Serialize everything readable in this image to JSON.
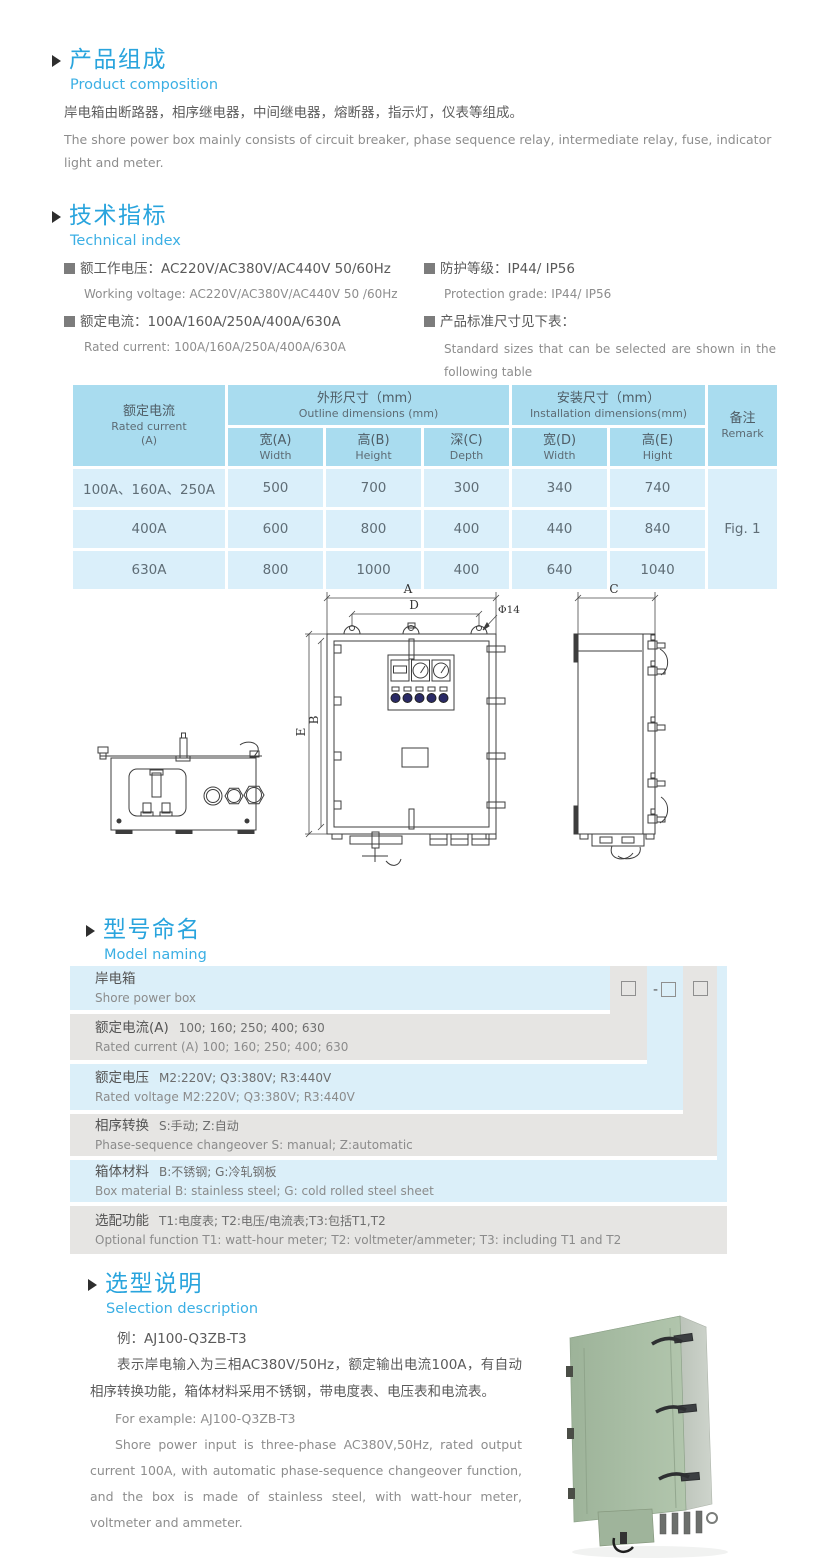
{
  "sec1": {
    "title_cn": "产品组成",
    "title_en": "Product  composition",
    "body_cn": "岸电箱由断路器，相序继电器，中间继电器，熔断器，指示灯，仪表等组成。",
    "body_en": "The shore power box mainly consists of circuit breaker, phase sequence relay, intermediate relay, fuse, indicator light and meter."
  },
  "sec2": {
    "title_cn": "技术指标",
    "title_en": "Technical index",
    "specs": [
      {
        "cn": "额工作电压：AC220V/AC380V/AC440V  50/60Hz",
        "en": "Working voltage: AC220V/AC380V/AC440V 50 /60Hz"
      },
      {
        "cn": "额定电流：100A/160A/250A/400A/630A",
        "en": "Rated current: 100A/160A/250A/400A/630A"
      },
      {
        "cn": "防护等级：IP44/ IP56",
        "en": "Protection grade: IP44/ IP56"
      },
      {
        "cn": "产品标准尺寸见下表：",
        "en": "Standard sizes that can be selected are shown in the following table"
      }
    ]
  },
  "dim_table": {
    "header": {
      "current_cn": "额定电流",
      "current_en": "Rated current",
      "current_unit": "(A)",
      "outline_cn": "外形尺寸（mm）",
      "outline_en": "Outline dimensions (mm)",
      "install_cn": "安装尺寸（mm）",
      "install_en": "Installation dimensions(mm)",
      "remark_cn": "备注",
      "remark_en": "Remark",
      "cols": [
        {
          "cn": "宽(A)",
          "en": "Width"
        },
        {
          "cn": "高(B)",
          "en": "Height"
        },
        {
          "cn": "深(C)",
          "en": "Depth"
        },
        {
          "cn": "宽(D)",
          "en": "Width"
        },
        {
          "cn": "高(E)",
          "en": "Hight"
        }
      ]
    },
    "rows": [
      {
        "current": "100A、160A、250A",
        "a": "500",
        "b": "700",
        "c": "300",
        "d": "340",
        "e": "740"
      },
      {
        "current": "400A",
        "a": "600",
        "b": "800",
        "c": "400",
        "d": "440",
        "e": "840"
      },
      {
        "current": "630A",
        "a": "800",
        "b": "1000",
        "c": "400",
        "d": "640",
        "e": "1040"
      }
    ],
    "remark": "Fig. 1"
  },
  "drawing": {
    "labels": {
      "a": "A",
      "d": "D",
      "dia": "Φ14",
      "e": "E",
      "b": "B",
      "c": "C"
    }
  },
  "sec3": {
    "title_cn": "型号命名",
    "title_en": "Model naming",
    "prefix": "AJ",
    "dash": "-",
    "rows": [
      {
        "cn": "岸电箱",
        "en": "Shore power box"
      },
      {
        "cn": "额定电流(A)",
        "detail": "100; 160; 250; 400; 630",
        "en": "Rated current (A) 100; 160; 250; 400; 630"
      },
      {
        "cn": "额定电压",
        "detail": "M2:220V;  Q3:380V;  R3:440V",
        "en": "Rated voltage  M2:220V;  Q3:380V;  R3:440V"
      },
      {
        "cn": "相序转换",
        "detail": "S:手动; Z:自动",
        "en": "Phase-sequence changeover  S: manual;  Z:automatic"
      },
      {
        "cn": "箱体材料",
        "detail": "B:不锈钢;  G:冷轧钢板",
        "en": "Box material   B: stainless steel; G: cold rolled steel sheet"
      },
      {
        "cn": "选配功能",
        "detail": "T1:电度表;  T2:电压/电流表;T3:包括T1,T2",
        "en": "Optional function  T1: watt-hour meter; T2: voltmeter/ammeter; T3: including T1 and T2"
      }
    ]
  },
  "sec4": {
    "title_cn": "选型说明",
    "title_en": "Selection description",
    "example_cn": "例：AJ100-Q3ZB-T3",
    "body_cn": "表示岸电输入为三相AC380V/50Hz，额定输出电流100A，有自动相序转换功能，箱体材料采用不锈钢，带电度表、电压表和电流表。",
    "example_en": "For example: AJ100-Q3ZB-T3",
    "body_en": "Shore power input is three-phase AC380V,50Hz, rated output current 100A, with automatic phase-sequence changeover function, and the box is made of stainless steel, with watt-hour meter, voltmeter and ammeter."
  },
  "colors": {
    "accent_blue": "#29a4dd",
    "subtitle_blue": "#3bafe4",
    "table_header_blue": "#a9dcef",
    "table_row_blue": "#daeffa",
    "model_row_blue": "#dbeff9",
    "model_row_gray": "#e6e5e3",
    "cabinet_green": "#a8bda4"
  }
}
